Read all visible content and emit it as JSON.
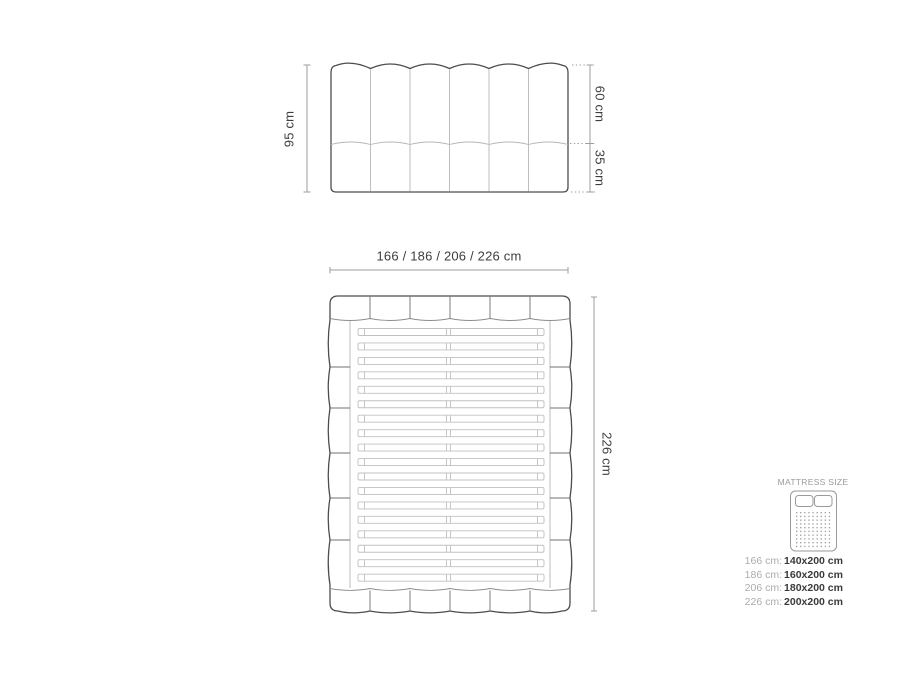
{
  "dimensions": {
    "headboard_height": "95 cm",
    "headboard_upper": "60 cm",
    "headboard_lower": "35 cm",
    "bed_widths": "166 / 186 / 206 / 226 cm",
    "bed_length": "226 cm"
  },
  "mattress_panel": {
    "title": "MATTRESS SIZE",
    "rows": [
      {
        "width": "166 cm:",
        "size": "140x200 cm"
      },
      {
        "width": "186 cm:",
        "size": "160x200 cm"
      },
      {
        "width": "206 cm:",
        "size": "180x200 cm"
      },
      {
        "width": "226 cm:",
        "size": "200x200 cm"
      }
    ]
  },
  "diagram": {
    "headboard_channels": 6,
    "slat_count": 18,
    "colors": {
      "outline": "#4d4d4d",
      "light_line": "#b6b6b6",
      "medium_line": "#707070",
      "dimension_line": "#9e9e9e",
      "label_text": "#3d3d3d",
      "muted_text": "#acacac",
      "value_text": "#3a3a3a",
      "background": "#ffffff"
    }
  }
}
